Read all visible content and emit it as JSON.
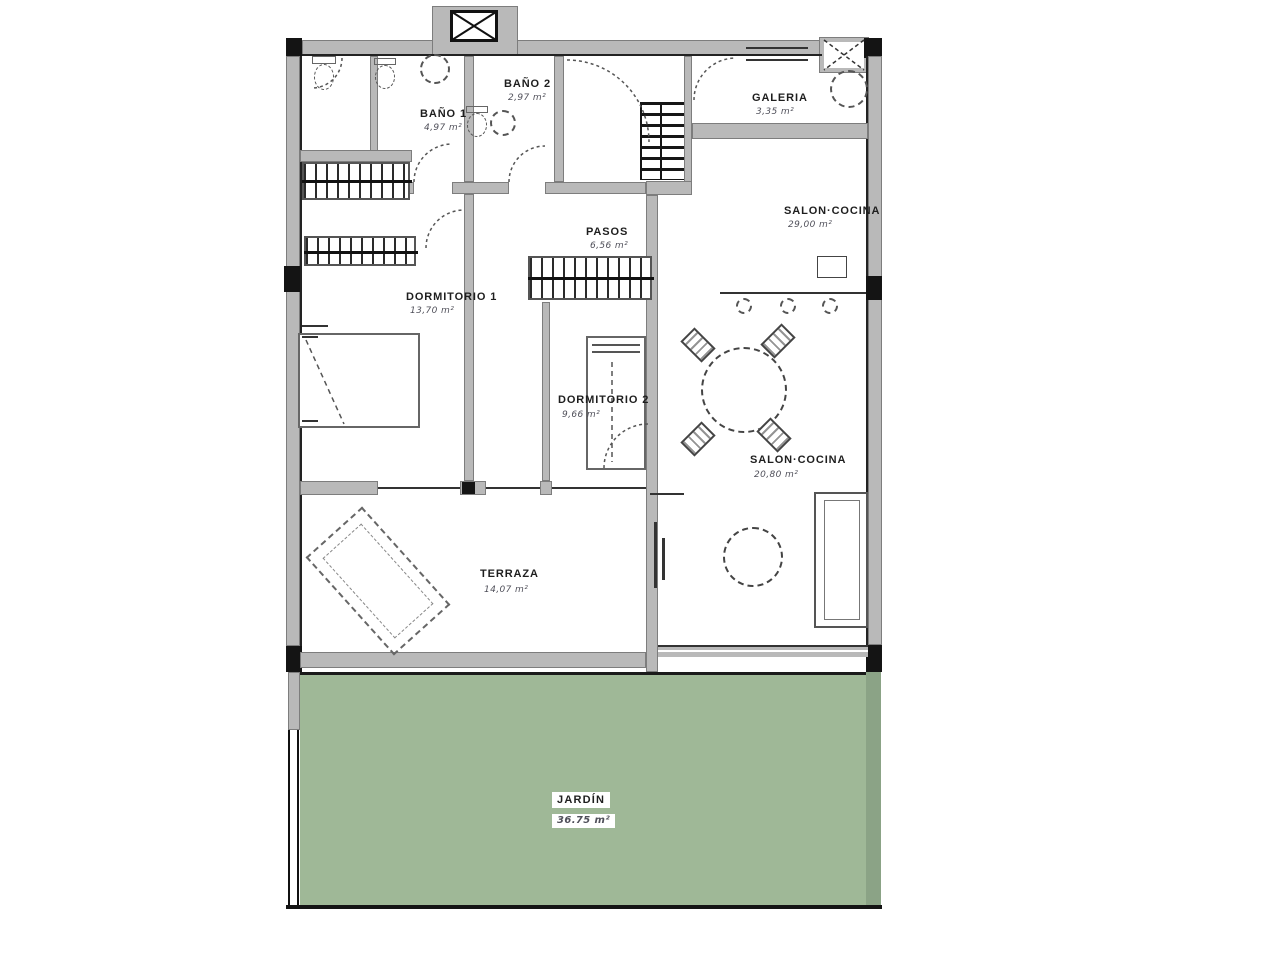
{
  "colors": {
    "wall": "#b9b9b9",
    "wall_edge": "#7d7d7d",
    "line": "#141414",
    "garden": "#9fb897",
    "garden_edge": "#8ba386",
    "label": "#1e1e1e",
    "area_text": "#50505a"
  },
  "rooms": {
    "bano1": {
      "label": "BAÑO 1",
      "area": "4,97 m²"
    },
    "bano2": {
      "label": "BAÑO 2",
      "area": "2,97 m²"
    },
    "galeria": {
      "label": "GALERIA",
      "area": "3,35 m²"
    },
    "salon_cocina_top": {
      "label": "SALON·COCINA",
      "area": "29,00 m²"
    },
    "pasos": {
      "label": "PASOS",
      "area": "6,56 m²"
    },
    "dormitorio1": {
      "label": "DORMITORIO 1",
      "area": "13,70 m²"
    },
    "dormitorio2": {
      "label": "DORMITORIO 2",
      "area": "9,66 m²"
    },
    "salon_cocina": {
      "label": "SALON·COCINA",
      "area": "20,80 m²"
    },
    "terraza": {
      "label": "TERRAZA",
      "area": "14,07 m²"
    },
    "jardin": {
      "label": "JARDÍN",
      "area": "36.75 m²"
    }
  },
  "icons": [
    "elevator-icon",
    "vent-shaft-icon",
    "stairs-icon",
    "wardrobe-icon",
    "toilet-icon",
    "bidet-icon",
    "shower-icon",
    "sink-icon",
    "washing-machine-icon",
    "kitchen-island-icon",
    "bar-stool-icon",
    "dining-table-icon",
    "chair-icon",
    "sofa-icon",
    "coffee-table-icon",
    "tv-unit-icon",
    "bed-icon",
    "lounge-chair-icon",
    "door-arc-icon",
    "column-icon",
    "fence-icon"
  ]
}
